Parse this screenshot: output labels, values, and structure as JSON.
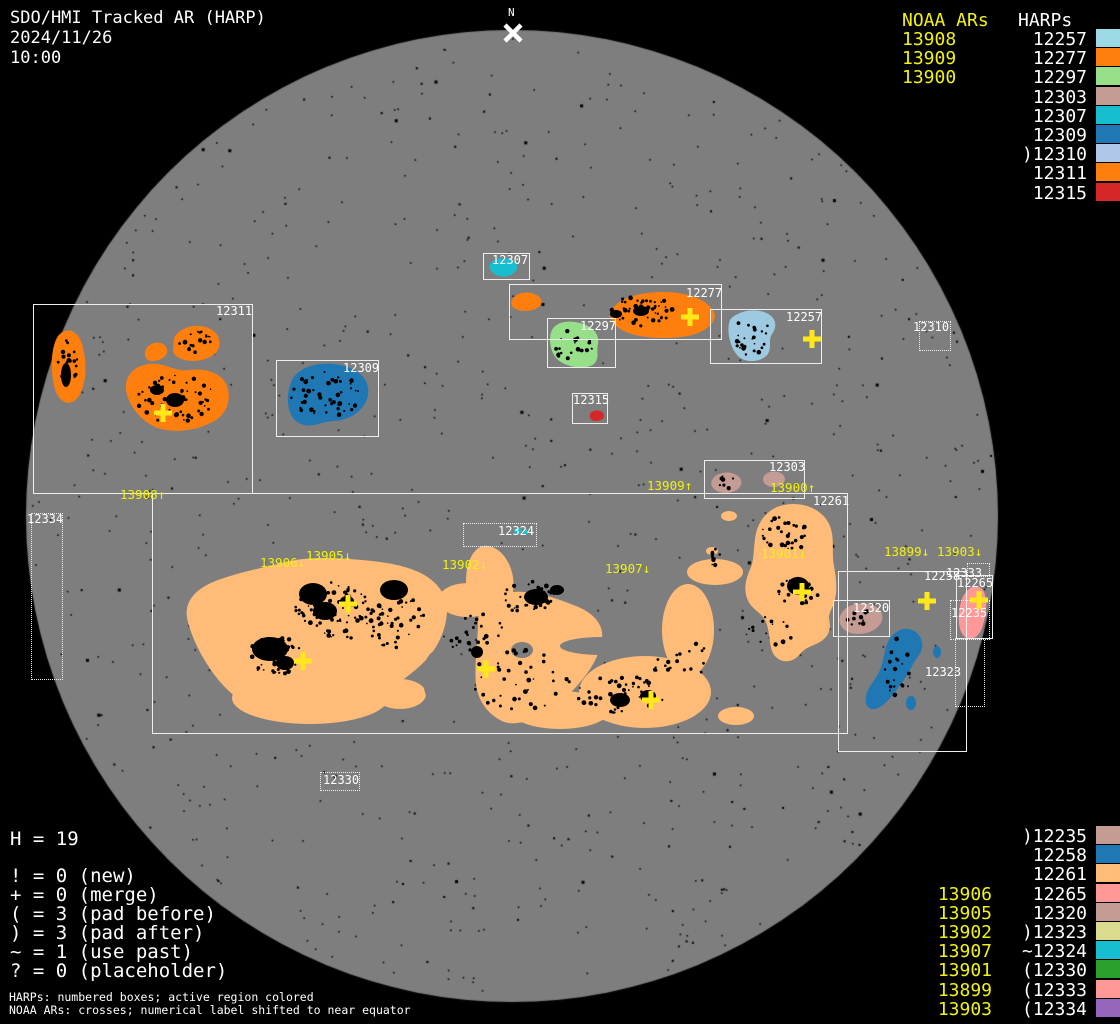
{
  "title": {
    "line1": "SDO/HMI Tracked AR (HARP)",
    "line2": "2024/11/26",
    "line3": "10:00"
  },
  "north_marker": {
    "label": "N"
  },
  "palette": {
    "background": "#000000",
    "disk": "#7e7e7e",
    "white": "#ffffff",
    "yellow": "#f2f20e",
    "cross_yellow": "#ffe81a",
    "orange": "#ff7f0e",
    "peach": "#ffbb78",
    "lightblue": "#9ecae1",
    "paleblue": "#aec7e8",
    "lightgreen": "#98df8a",
    "teal": "#17becf",
    "blue": "#1f77b4",
    "rosy": "#c49c94",
    "red": "#d62728",
    "salmon": "#ff9896",
    "khaki": "#dbdb8d",
    "green": "#2ca02c",
    "purple": "#9467bd",
    "black": "#000000"
  },
  "disk": {
    "cx": 512,
    "cy": 516,
    "r": 486
  },
  "legend_top_right": {
    "noaa_header": "NOAA ARs",
    "harp_header": "HARPs",
    "noaa": [
      "13908",
      "13909",
      "13900"
    ],
    "harps": [
      {
        "prefix": "",
        "id": "12257",
        "color": "#9edae5"
      },
      {
        "prefix": "",
        "id": "12277",
        "color": "#ff7f0e"
      },
      {
        "prefix": "",
        "id": "12297",
        "color": "#98df8a"
      },
      {
        "prefix": "",
        "id": "12303",
        "color": "#c49c94"
      },
      {
        "prefix": "",
        "id": "12307",
        "color": "#17becf"
      },
      {
        "prefix": "",
        "id": "12309",
        "color": "#1f77b4"
      },
      {
        "prefix": ")",
        "id": "12310",
        "color": "#aec7e8"
      },
      {
        "prefix": "",
        "id": "12311",
        "color": "#ff7f0e"
      },
      {
        "prefix": "",
        "id": "12315",
        "color": "#d62728"
      }
    ]
  },
  "legend_bottom_right": {
    "rows": [
      {
        "noaa": "",
        "prefix": ")",
        "id": "12235",
        "color": "#c49c94"
      },
      {
        "noaa": "",
        "prefix": "",
        "id": "12258",
        "color": "#1f77b4"
      },
      {
        "noaa": "",
        "prefix": "",
        "id": "12261",
        "color": "#ffbb78"
      },
      {
        "noaa": "13906",
        "prefix": "",
        "id": "12265",
        "color": "#ff9896"
      },
      {
        "noaa": "13905",
        "prefix": "",
        "id": "12320",
        "color": "#c49c94"
      },
      {
        "noaa": "13902",
        "prefix": ")",
        "id": "12323",
        "color": "#dbdb8d"
      },
      {
        "noaa": "13907",
        "prefix": "~",
        "id": "12324",
        "color": "#17becf"
      },
      {
        "noaa": "13901",
        "prefix": "(",
        "id": "12330",
        "color": "#2ca02c"
      },
      {
        "noaa": "13899",
        "prefix": "(",
        "id": "12333",
        "color": "#ff9896"
      },
      {
        "noaa": "13903",
        "prefix": "(",
        "id": "12334",
        "color": "#9467bd"
      }
    ]
  },
  "legend_bottom_left": {
    "h_line": "H = 19",
    "symbols": [
      "! = 0 (new)",
      "+ = 0 (merge)",
      "( = 3 (pad before)",
      ") = 3 (pad after)",
      "~ = 1 (use past)",
      "? = 0 (placeholder)"
    ],
    "note1": "HARPs: numbered boxes; active region colored",
    "note2": "NOAA ARs: crosses; numerical label shifted to near equator"
  },
  "harp_boxes": [
    {
      "id": "12311",
      "style": "solid",
      "x": 33,
      "y": 304,
      "w": 220,
      "h": 190,
      "lx": 216,
      "ly": 305
    },
    {
      "id": "12309",
      "style": "solid",
      "x": 276,
      "y": 360,
      "w": 103,
      "h": 77,
      "lx": 343,
      "ly": 362
    },
    {
      "id": "12307",
      "style": "solid",
      "x": 483,
      "y": 253,
      "w": 47,
      "h": 27,
      "lx": 492,
      "ly": 254
    },
    {
      "id": "12277",
      "style": "solid",
      "x": 509,
      "y": 284,
      "w": 213,
      "h": 56,
      "lx": 686,
      "ly": 287
    },
    {
      "id": "12297",
      "style": "solid",
      "x": 547,
      "y": 318,
      "w": 69,
      "h": 50,
      "lx": 580,
      "ly": 320
    },
    {
      "id": "12257",
      "style": "solid",
      "x": 710,
      "y": 309,
      "w": 112,
      "h": 55,
      "lx": 786,
      "ly": 311
    },
    {
      "id": "12315",
      "style": "solid",
      "x": 572,
      "y": 393,
      "w": 36,
      "h": 31,
      "lx": 573,
      "ly": 394
    },
    {
      "id": "12303",
      "style": "solid",
      "x": 704,
      "y": 460,
      "w": 101,
      "h": 39,
      "lx": 769,
      "ly": 461
    },
    {
      "id": "12261",
      "style": "solid",
      "x": 152,
      "y": 493,
      "w": 696,
      "h": 241,
      "lx": 813,
      "ly": 495
    },
    {
      "id": "12320",
      "style": "solid",
      "x": 833,
      "y": 600,
      "w": 57,
      "h": 37,
      "lx": 853,
      "ly": 602
    },
    {
      "id": "12258",
      "style": "solid",
      "x": 838,
      "y": 571,
      "w": 129,
      "h": 181,
      "lx": 924,
      "ly": 570
    },
    {
      "id": "12265",
      "style": "solid",
      "x": 956,
      "y": 575,
      "w": 37,
      "h": 64,
      "lx": 957,
      "ly": 577
    },
    {
      "id": "12310",
      "style": "dotted",
      "x": 919,
      "y": 321,
      "w": 32,
      "h": 30,
      "lx": 913,
      "ly": 321
    },
    {
      "id": "12334",
      "style": "dotted",
      "x": 31,
      "y": 513,
      "w": 32,
      "h": 167,
      "lx": 27,
      "ly": 513
    },
    {
      "id": "12324",
      "style": "dotted",
      "x": 463,
      "y": 523,
      "w": 74,
      "h": 24,
      "lx": 498,
      "ly": 525
    },
    {
      "id": "12330",
      "style": "dotted",
      "x": 320,
      "y": 772,
      "w": 40,
      "h": 19,
      "lx": 323,
      "ly": 774
    },
    {
      "id": "12323",
      "style": "dotted",
      "x": 955,
      "y": 638,
      "w": 30,
      "h": 69,
      "lx": 925,
      "ly": 666
    },
    {
      "id": "12235",
      "style": "dotted",
      "x": 950,
      "y": 600,
      "w": 40,
      "h": 40,
      "lx": 951,
      "ly": 607
    },
    {
      "id": "12333",
      "style": "dotted",
      "x": 967,
      "y": 563,
      "w": 23,
      "h": 14,
      "lx": 946,
      "ly": 567
    }
  ],
  "noaa_labels": [
    {
      "text": "13908↑",
      "x": 120,
      "y": 488
    },
    {
      "text": "13909↑",
      "x": 647,
      "y": 479
    },
    {
      "text": "13900↑",
      "x": 770,
      "y": 481
    },
    {
      "text": "13906↓",
      "x": 260,
      "y": 556
    },
    {
      "text": "13905↓",
      "x": 306,
      "y": 549
    },
    {
      "text": "13902↓",
      "x": 442,
      "y": 558
    },
    {
      "text": "13907↓",
      "x": 605,
      "y": 562
    },
    {
      "text": "13901↓",
      "x": 761,
      "y": 547
    },
    {
      "text": "13899↓",
      "x": 884,
      "y": 545
    },
    {
      "text": "13903↓",
      "x": 937,
      "y": 545
    }
  ],
  "crosses": [
    {
      "x": 163,
      "y": 413
    },
    {
      "x": 690,
      "y": 317
    },
    {
      "x": 812,
      "y": 339
    },
    {
      "x": 348,
      "y": 604
    },
    {
      "x": 303,
      "y": 661
    },
    {
      "x": 486,
      "y": 669
    },
    {
      "x": 651,
      "y": 700
    },
    {
      "x": 802,
      "y": 592
    },
    {
      "x": 927,
      "y": 601
    },
    {
      "x": 979,
      "y": 600
    }
  ],
  "chart_data": {
    "type": "scatter",
    "title": "SDO/HMI Tracked AR (HARP) 2024/11/26 10:00",
    "harp_count": 19,
    "harps_on_disk": [
      "12235",
      "12257",
      "12258",
      "12261",
      "12265",
      "12277",
      "12297",
      "12303",
      "12307",
      "12309",
      "12310",
      "12311",
      "12315",
      "12320",
      "12323",
      "12324",
      "12330",
      "12333",
      "12334"
    ],
    "noaa_ars": [
      "13899",
      "13900",
      "13901",
      "13902",
      "13903",
      "13905",
      "13906",
      "13907",
      "13908",
      "13909"
    ],
    "legend_position": "right",
    "notes": "numbered boxes = HARPs, yellow crosses = NOAA ARs"
  }
}
